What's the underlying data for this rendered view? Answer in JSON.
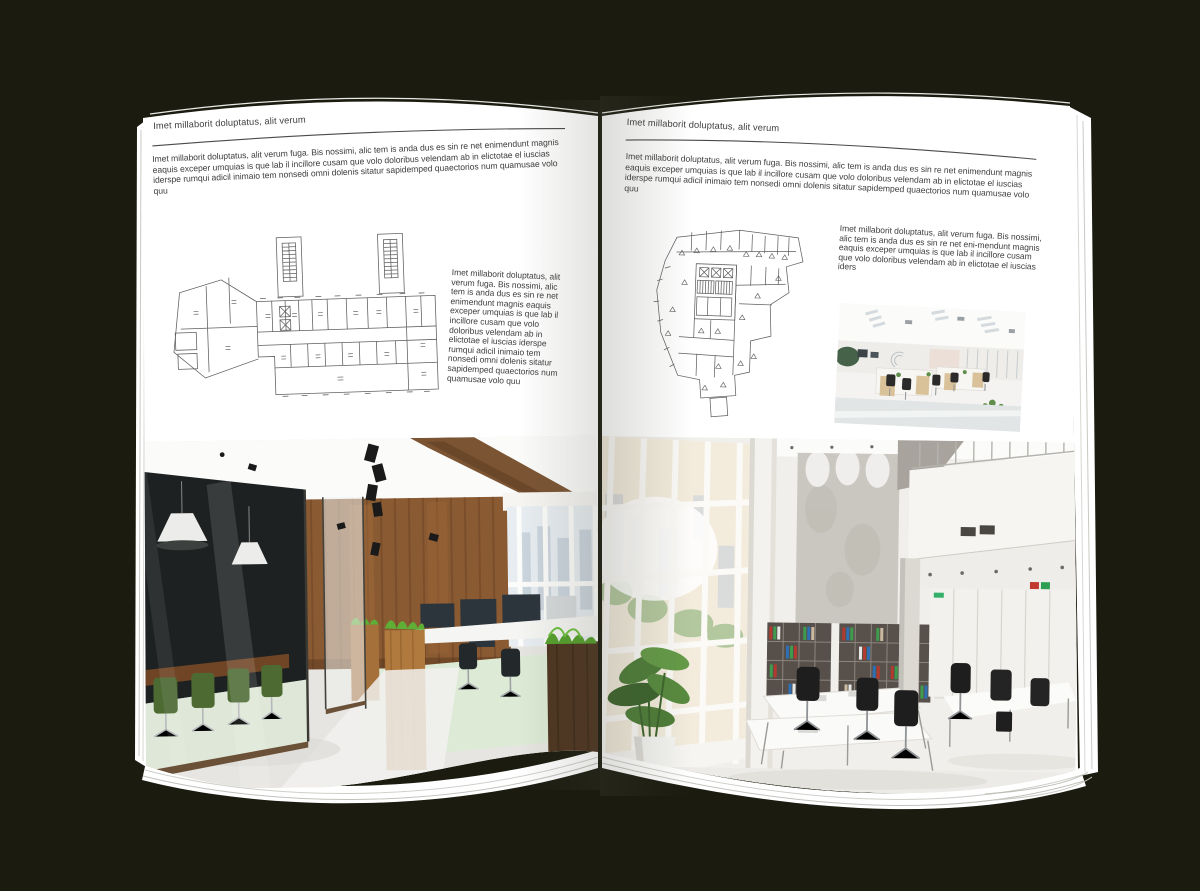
{
  "colors": {
    "backdrop": "#1b1c0f",
    "page": "#ffffff",
    "ink": "#3e3e3e",
    "rule": "#4a4a4a",
    "plan_line": "#5f5f5f",
    "wood": "#8a5a32",
    "walnut": "#4e3520",
    "grass_green": "#5fae35",
    "chair_green": "#4d6a33",
    "binder_red": "#b33a2e",
    "binder_blue": "#2f6fb3",
    "binder_green": "#3f9c4e"
  },
  "page_left": {
    "header": "Imet millaborit doluptatus, alit verum",
    "intro": "Imet millaborit doluptatus, alit verum fuga. Bis nossimi, alic tem is anda dus es sin re net enimendunt magnis eaquis exceper umquias is que lab il incillore cusam que volo doloribus velendam ab in elictotae el iuscias iderspe rumqui adicil inimaio tem nonsedi omni dolenis sitatur sapidemped quaectorios num quamusae volo quu",
    "caption": "Imet millaborit doluptatus, alit verum fuga. Bis nossimi, alic tem is anda dus es sin re net enimendunt magnis eaquis exceper umquias is que lab il incillore cusam que volo doloribus velendam ab in elictotae el iuscias iderspe rumqui adicil inimaio tem nonsedi omni dolenis sitatur sapidemped quaectorios num quamusae volo quu",
    "figures": {
      "floorplan": "architectural-floor-plan-wide-building",
      "photo": "office-interior-wood-and-glass"
    }
  },
  "page_right": {
    "header": "Imet millaborit doluptatus, alit verum",
    "intro": "Imet millaborit doluptatus, alit verum fuga. Bis nossimi, alic tem is anda dus es sin re net enimendunt magnis eaquis exceper umquias is que lab il incillore cusam que volo doloribus velendam ab in elictotae el iuscias iderspe rumqui adicil inimaio tem nonsedi omni dolenis sitatur sapidemped quaectorios num quamusae volo quu",
    "caption": "Imet millaborit doluptatus, alit verum fuga. Bis nossimi, alic tem is anda dus es sin re net eni-mendunt magnis eaquis exceper umquias is que lab il incillore cusam que volo doloribus velendam ab in elictotae el iuscias iders",
    "figures": {
      "floorplan": "architectural-floor-plan-irregular-building",
      "photo_small": "open-office-white-desks",
      "photo_large": "atrium-office-tall-windows"
    }
  }
}
